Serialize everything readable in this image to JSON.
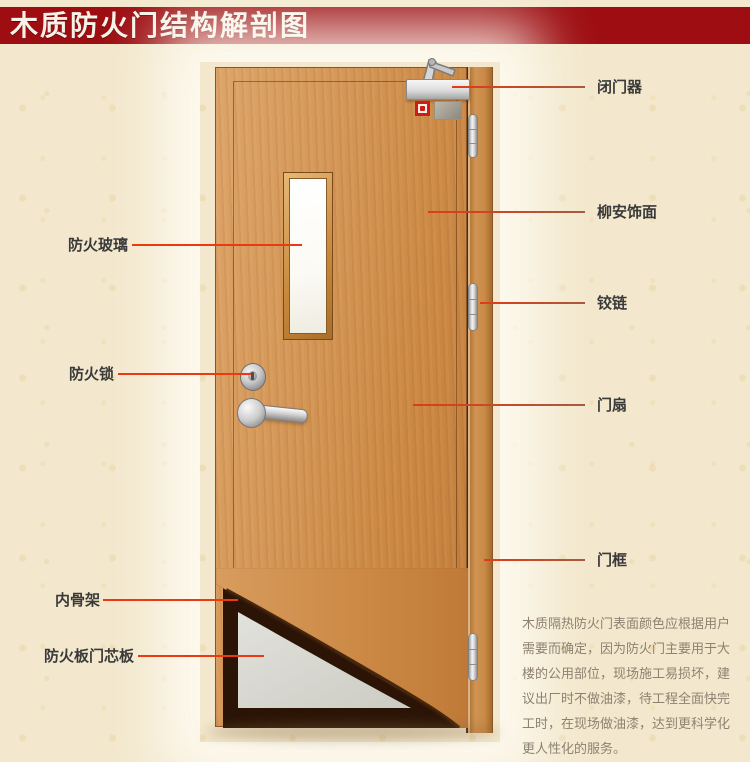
{
  "title": "木质防火门结构解剖图",
  "labels": {
    "fire_glass": "防火玻璃",
    "fire_lock": "防火锁",
    "inner_frame": "内骨架",
    "core_board": "防火板门芯板",
    "door_closer": "闭门器",
    "veneer": "柳安饰面",
    "hinge": "铰链",
    "door_leaf": "门扇",
    "door_frame": "门框"
  },
  "description": {
    "lines": [
      "木质隔热防火门表面颜色应根据用户",
      "需要而确定，因为防火门主要用于大",
      "楼的公用部位，现场施工易损坏，建",
      "议出厂时不做油漆，待工程全面快完",
      "工时，在现场做油漆，达到更科学化",
      "更人性化的服务。"
    ]
  },
  "colors": {
    "banner": "#9d0d11",
    "background": "#f3e8cd",
    "leader_left": "#ea3a12",
    "leader_right": "#b5502e",
    "wood": "#cf8c4c",
    "core_board_fill": "#d9d9d2",
    "skeleton": "#2b1406"
  }
}
